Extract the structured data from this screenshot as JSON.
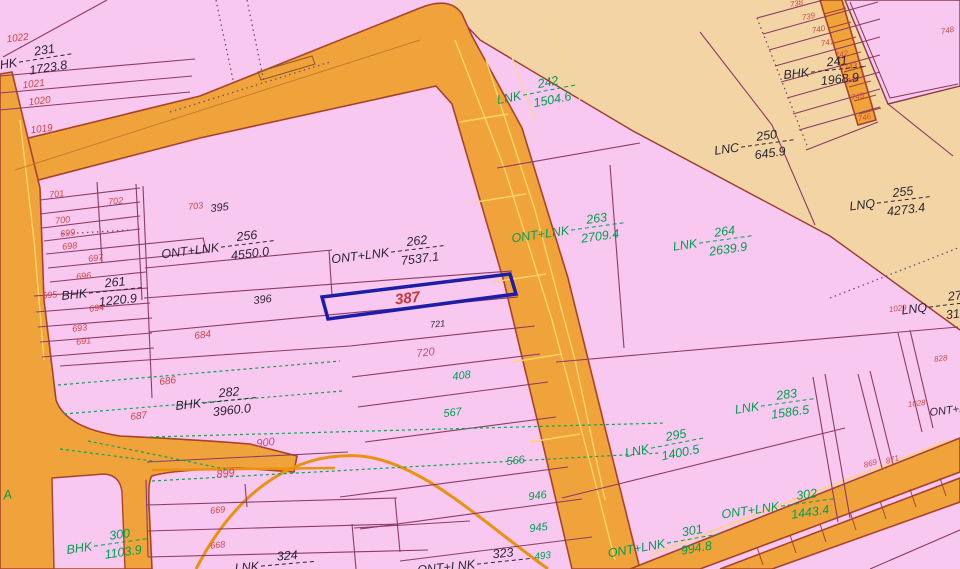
{
  "map": {
    "selected_parcel": {
      "number": "387",
      "x": 408,
      "y": 303,
      "rot": -7
    },
    "colors": {
      "pink": "#f8c8f0",
      "tan": "#f3d4a4",
      "road_orange": "#f1a33b",
      "road_outline": "#a8432a",
      "parcel_line": "#8c3b66",
      "green_survey": "#0fa352",
      "highlight_blue": "#1d1da8",
      "k": "#2d2633",
      "r": "#cf4545",
      "g": "#00a04f",
      "m": "#bf4a86",
      "rs": "#cc4c4c",
      "sel": "#d03333",
      "yellow_mark": "#ffd469"
    },
    "fraction_labels": [
      {
        "p": "BHK",
        "n": "231",
        "d": "1723.8",
        "x": 20,
        "y": 62,
        "r": -9,
        "c": "k"
      },
      {
        "p": "ONT+LNK",
        "n": "256",
        "d": "4550.0",
        "x": 222,
        "y": 247,
        "r": -7,
        "c": "k"
      },
      {
        "p": "BHK",
        "n": "261",
        "d": "1220.9",
        "x": 90,
        "y": 293,
        "r": -6,
        "c": "k"
      },
      {
        "p": "ONT+LNK",
        "n": "262",
        "d": "7537.1",
        "x": 392,
        "y": 252,
        "r": -7,
        "c": "k"
      },
      {
        "p": "BHK",
        "n": "282",
        "d": "3960.0",
        "x": 204,
        "y": 403,
        "r": -6,
        "c": "k"
      },
      {
        "p": "BHK",
        "n": "300",
        "d": "1103.9",
        "x": 95,
        "y": 546,
        "r": -8,
        "c": "g"
      },
      {
        "p": "LNK",
        "n": "242",
        "d": "1504.6",
        "x": 524,
        "y": 95,
        "r": -11,
        "c": "g"
      },
      {
        "p": "ONT+LNK",
        "n": "263",
        "d": "2709.4",
        "x": 572,
        "y": 230,
        "r": -8,
        "c": "g"
      },
      {
        "p": "LNK",
        "n": "264",
        "d": "2639.9",
        "x": 700,
        "y": 243,
        "r": -8,
        "c": "g"
      },
      {
        "p": "LNC",
        "n": "250",
        "d": "645.9",
        "x": 742,
        "y": 147,
        "r": -8,
        "c": "k"
      },
      {
        "p": "BHK",
        "n": "241",
        "d": "1968.9",
        "x": 812,
        "y": 72,
        "r": -6,
        "c": "k"
      },
      {
        "p": "LNQ",
        "n": "255",
        "d": "4273.4",
        "x": 878,
        "y": 203,
        "r": -7,
        "c": "k"
      },
      {
        "p": "LNK",
        "n": "283",
        "d": "1586.5",
        "x": 762,
        "y": 406,
        "r": -8,
        "c": "g"
      },
      {
        "p": "LNK",
        "n": "295",
        "d": "1400.5",
        "x": 652,
        "y": 448,
        "r": -11,
        "c": "g"
      },
      {
        "p": "ONT+LNK",
        "n": "302",
        "d": "1443.4",
        "x": 782,
        "y": 506,
        "r": -8,
        "c": "g"
      },
      {
        "p": "ONT+LNK",
        "n": "301",
        "d": "994.8",
        "x": 668,
        "y": 543,
        "r": -10,
        "c": "g"
      },
      {
        "p": "ONT+LNK",
        "n": "323",
        "d": "",
        "x": 478,
        "y": 564,
        "r": -6,
        "c": "k"
      },
      {
        "p": "LNQ",
        "n": "27",
        "d": "316.",
        "x": 930,
        "y": 307,
        "r": -7,
        "c": "k"
      },
      {
        "p": "LNK",
        "n": "324",
        "d": "",
        "x": 262,
        "y": 566,
        "r": -5,
        "c": "k"
      }
    ],
    "number_labels": [
      {
        "t": "1022",
        "x": 18,
        "y": 41,
        "c": "r",
        "s": 10
      },
      {
        "t": "1021",
        "x": 34,
        "y": 87,
        "c": "r",
        "s": 10
      },
      {
        "t": "1020",
        "x": 40,
        "y": 104,
        "c": "r",
        "s": 10
      },
      {
        "t": "1019",
        "x": 42,
        "y": 132,
        "c": "r",
        "s": 10
      },
      {
        "t": "701",
        "x": 57,
        "y": 197,
        "c": "r",
        "s": 9
      },
      {
        "t": "702",
        "x": 116,
        "y": 204,
        "c": "r",
        "s": 9
      },
      {
        "t": "700",
        "x": 63,
        "y": 223,
        "c": "r",
        "s": 9
      },
      {
        "t": "699",
        "x": 68,
        "y": 236,
        "c": "r",
        "s": 9
      },
      {
        "t": "698",
        "x": 70,
        "y": 249,
        "c": "r",
        "s": 9
      },
      {
        "t": "697",
        "x": 96,
        "y": 261,
        "c": "r",
        "s": 9
      },
      {
        "t": "696",
        "x": 84,
        "y": 279,
        "c": "r",
        "s": 9
      },
      {
        "t": "695",
        "x": 50,
        "y": 298,
        "c": "r",
        "s": 9
      },
      {
        "t": "694",
        "x": 97,
        "y": 311,
        "c": "r",
        "s": 9
      },
      {
        "t": "693",
        "x": 80,
        "y": 331,
        "c": "r",
        "s": 9
      },
      {
        "t": "691",
        "x": 84,
        "y": 344,
        "c": "r",
        "s": 9
      },
      {
        "t": "703",
        "x": 196,
        "y": 209,
        "c": "r",
        "s": 9
      },
      {
        "t": "395",
        "x": 220,
        "y": 211,
        "c": "k",
        "s": 11
      },
      {
        "t": "396",
        "x": 263,
        "y": 303,
        "c": "k",
        "s": 11
      },
      {
        "t": "721",
        "x": 438,
        "y": 327,
        "c": "k",
        "s": 9
      },
      {
        "t": "684",
        "x": 203,
        "y": 338,
        "c": "r",
        "s": 10
      },
      {
        "t": "686",
        "x": 168,
        "y": 384,
        "c": "r",
        "s": 10
      },
      {
        "t": "687",
        "x": 139,
        "y": 419,
        "c": "r",
        "s": 10
      },
      {
        "t": "900",
        "x": 266,
        "y": 446,
        "c": "m",
        "s": 11
      },
      {
        "t": "899",
        "x": 226,
        "y": 477,
        "c": "r",
        "s": 11
      },
      {
        "t": "669",
        "x": 218,
        "y": 513,
        "c": "r",
        "s": 9
      },
      {
        "t": "668",
        "x": 218,
        "y": 548,
        "c": "r",
        "s": 9
      },
      {
        "t": "720",
        "x": 426,
        "y": 356,
        "c": "m",
        "s": 11
      },
      {
        "t": "408",
        "x": 462,
        "y": 379,
        "c": "g",
        "s": 11
      },
      {
        "t": "567",
        "x": 453,
        "y": 416,
        "c": "g",
        "s": 11
      },
      {
        "t": "566",
        "x": 516,
        "y": 464,
        "c": "g",
        "s": 11
      },
      {
        "t": "946",
        "x": 538,
        "y": 499,
        "c": "g",
        "s": 11
      },
      {
        "t": "945",
        "x": 539,
        "y": 531,
        "c": "g",
        "s": 11
      },
      {
        "t": "493",
        "x": 543,
        "y": 559,
        "c": "g",
        "s": 10
      },
      {
        "t": "738",
        "x": 797,
        "y": 6,
        "c": "rs",
        "s": 8,
        "r": -12
      },
      {
        "t": "739",
        "x": 809,
        "y": 19,
        "c": "rs",
        "s": 8,
        "r": -12
      },
      {
        "t": "740",
        "x": 819,
        "y": 32,
        "c": "rs",
        "s": 8,
        "r": -12
      },
      {
        "t": "741",
        "x": 828,
        "y": 45,
        "c": "rs",
        "s": 8,
        "r": -12
      },
      {
        "t": "742",
        "x": 842,
        "y": 57,
        "c": "rs",
        "s": 8,
        "r": -12
      },
      {
        "t": "743",
        "x": 851,
        "y": 69,
        "c": "rs",
        "s": 8,
        "r": -12
      },
      {
        "t": "744",
        "x": 853,
        "y": 83,
        "c": "rs",
        "s": 8,
        "r": -12
      },
      {
        "t": "745",
        "x": 858,
        "y": 99,
        "c": "rs",
        "s": 8,
        "r": -12
      },
      {
        "t": "746",
        "x": 865,
        "y": 120,
        "c": "rs",
        "s": 8,
        "r": -12
      },
      {
        "t": "748",
        "x": 948,
        "y": 33,
        "c": "rs",
        "s": 8,
        "r": -12
      },
      {
        "t": "1029",
        "x": 898,
        "y": 311,
        "c": "rs",
        "s": 8
      },
      {
        "t": "828",
        "x": 941,
        "y": 361,
        "c": "rs",
        "s": 8
      },
      {
        "t": "1028",
        "x": 917,
        "y": 406,
        "c": "rs",
        "s": 8
      },
      {
        "t": "869",
        "x": 871,
        "y": 466,
        "c": "rs",
        "s": 8,
        "r": -15
      },
      {
        "t": "871",
        "x": 893,
        "y": 462,
        "c": "rs",
        "s": 8,
        "r": -15
      },
      {
        "t": "A",
        "x": 8,
        "y": 499,
        "c": "g",
        "s": 13
      },
      {
        "t": "ONT+L",
        "x": 930,
        "y": 416,
        "c": "k",
        "s": 11,
        "a": "start"
      }
    ]
  }
}
